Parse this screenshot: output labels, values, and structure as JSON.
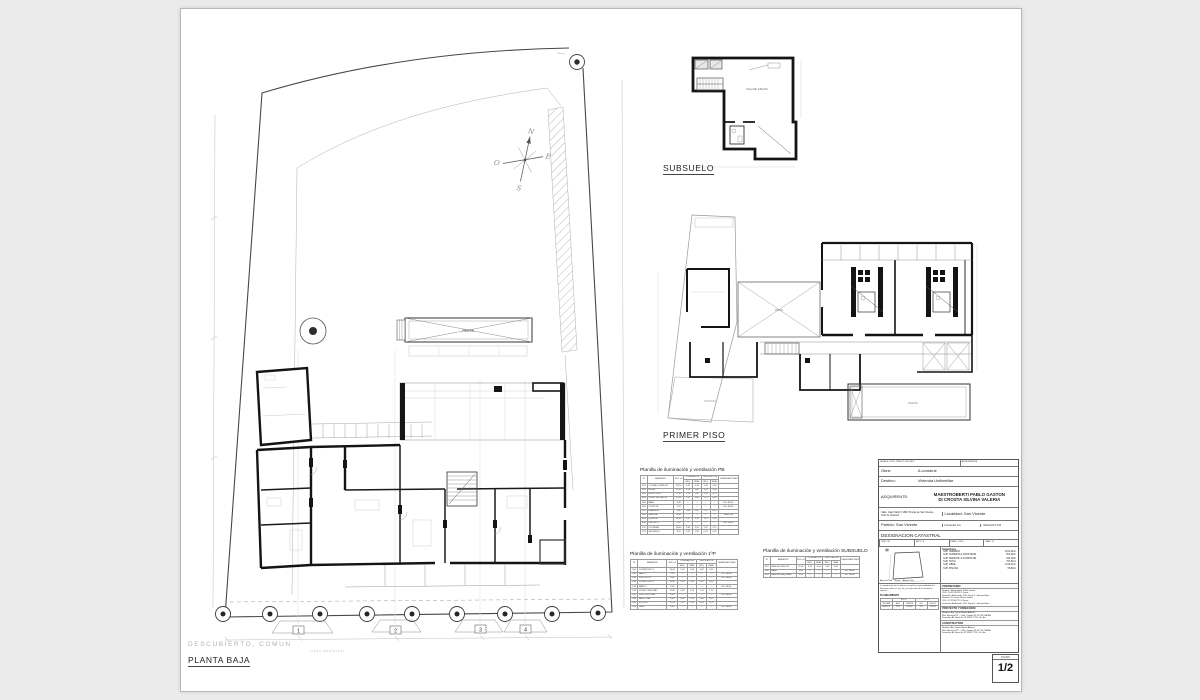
{
  "page": {
    "plano_label": "PLANO",
    "plano_value": "1/2"
  },
  "labels": {
    "planta_baja": "PLANTA BAJA",
    "subsuelo": "SUBSUELO",
    "primer_piso": "PRIMER PISO",
    "descubierto": "DESCUBIERTO, COMUN"
  },
  "compass": {
    "n": "N",
    "s": "S",
    "e": "E",
    "o": "O"
  },
  "site": {
    "pool_label": "PILETA",
    "grid_labels": [
      "1",
      "2",
      "3",
      "4"
    ],
    "street_note": "LINEA MUNICIPAL"
  },
  "plans": {
    "subsuelo_room": "SALA DE JUEGOS",
    "p1_void": "VACIO",
    "p1_terrace": "TERRAZA",
    "p1_pool": "PILETA"
  },
  "tables": {
    "common": {
      "n": "Nº",
      "amb": "AMBIENTE",
      "sup": "SUP. m²",
      "ilum": "ILUMINACION",
      "vent": "VENTILACION",
      "req": "REQ.",
      "real": "REAL",
      "obs": "OBSERVACIONES"
    },
    "pb": {
      "title": "Planilla de iluminación y ventilación PB",
      "rows": [
        [
          "E01",
          "COCINA-COMEDOR",
          "48,70",
          "4,87",
          "5,10",
          "2,43",
          "2,60",
          ""
        ],
        [
          "E02",
          "ESTAR",
          "32,40",
          "3,24",
          "3,60",
          "1,62",
          "1,80",
          ""
        ],
        [
          "E03",
          "ESCRITORIO",
          "12,60",
          "1,26",
          "1,40",
          "0,63",
          "0,70",
          ""
        ],
        [
          "E04",
          "DORM. INVITADOS",
          "14,20",
          "1,42",
          "1,60",
          "0,71",
          "0,80",
          ""
        ],
        [
          "E05",
          "BAÑO",
          "4,80",
          "—",
          "—",
          "—",
          "—",
          "S.E. REGL."
        ],
        [
          "E06",
          "TOILETTE",
          "2,10",
          "—",
          "—",
          "—",
          "—",
          "S.E. REGL."
        ],
        [
          "E07",
          "LAVADERO",
          "6,40",
          "0,64",
          "0,80",
          "0,32",
          "0,40",
          ""
        ],
        [
          "E08",
          "GALERIA",
          "28,60",
          "—",
          "—",
          "—",
          "—",
          "SEMICUB."
        ],
        [
          "E09",
          "QUINCHO",
          "36,20",
          "3,62",
          "4,10",
          "1,81",
          "2,05",
          ""
        ],
        [
          "E10",
          "DEPOSITO",
          "5,20",
          "—",
          "—",
          "—",
          "—",
          "S.E. REGL."
        ],
        [
          "E11",
          "COCHERA",
          "38,40",
          "3,84",
          "4,20",
          "1,92",
          "2,10",
          ""
        ],
        [
          "E12",
          "VESTIBULO",
          "8,10",
          "0,81",
          "1,00",
          "0,41",
          "0,50",
          ""
        ]
      ]
    },
    "p1": {
      "title": "Planilla de iluminación y ventilación 1ºP",
      "rows": [
        [
          "D01",
          "DORMITORIO 1",
          "16,40",
          "1,64",
          "1,80",
          "0,82",
          "0,90",
          ""
        ],
        [
          "D02",
          "BAÑO 1",
          "5,20",
          "—",
          "—",
          "—",
          "—",
          "S.E. REGL."
        ],
        [
          "D03",
          "VESTIDOR 1",
          "4,60",
          "—",
          "—",
          "—",
          "—",
          "S.E. REGL."
        ],
        [
          "D04",
          "DORMITORIO 2",
          "16,40",
          "1,64",
          "1,80",
          "0,82",
          "0,90",
          ""
        ],
        [
          "D05",
          "BAÑO 2",
          "5,20",
          "—",
          "—",
          "—",
          "—",
          "S.E. REGL."
        ],
        [
          "D06",
          "DORM. PRINCIPAL",
          "22,80",
          "2,28",
          "2,50",
          "1,14",
          "1,25",
          ""
        ],
        [
          "D07",
          "VESTIDOR PPAL.",
          "8,40",
          "—",
          "—",
          "—",
          "—",
          "S.E. REGL."
        ],
        [
          "D08",
          "BAÑO PPAL.",
          "9,60",
          "0,96",
          "1,10",
          "0,48",
          "0,55",
          ""
        ],
        [
          "D09",
          "ESTUDIO",
          "12,20",
          "1,22",
          "1,40",
          "0,61",
          "0,70",
          ""
        ],
        [
          "D10",
          "PASO",
          "6,80",
          "—",
          "—",
          "—",
          "—",
          "S.E. REGL."
        ]
      ]
    },
    "ss": {
      "title": "Planilla de iluminación y ventilación SUBSUELO",
      "rows": [
        [
          "S01",
          "SALA DE JUEGOS",
          "52,40",
          "5,24",
          "5,60",
          "2,62",
          "2,80",
          ""
        ],
        [
          "S02",
          "BAÑO",
          "3,80",
          "—",
          "—",
          "—",
          "—",
          "S.E. REGL."
        ],
        [
          "S03",
          "SALA DE MAQUINAS",
          "9,20",
          "—",
          "—",
          "—",
          "—",
          "S.E. REGL."
        ]
      ]
    }
  },
  "title_block": {
    "header_left": "GUIA DE CONT. TRIB. Nº 3-81 59F.3",
    "header_right": "ANTECEDENTE",
    "obra_label": "Obra:",
    "obra_value": "A construir",
    "destino_label": "Destino:",
    "destino_value": "Vivienda Unifamiliar",
    "adquirente_label": "ADQUIRENTE:",
    "adquirente_line1": "MAESTROBERTI PABLO GASTON",
    "adquirente_line2": "DI CROSTA SILVINA VALERIA",
    "calle": "Calle: Juan Pablo II 1660 \"Fincas de San Vicente - Club de Chacras\"",
    "localidad": "Localidad: San Vicente",
    "partido": "Partido: San Vicente",
    "fna": "Fna de Ets. No.",
    "escala": "ESCALAS 1:100",
    "catastral_title": "DESIGNACION CATASTRAL",
    "catastral_cells": [
      "CIRC: VII",
      "SECC: S",
      "FRACC: 2223",
      "PARC: 11"
    ],
    "superficies_title": "Superficies",
    "superficies": [
      [
        "SUP. TERRENO",
        "2014,22m²"
      ],
      [
        "SUP. CUBIERTA A CONSTRUIR",
        "551,62m²"
      ],
      [
        "SUP. SEMICUB. A CONSTRUIR",
        "246,19m²"
      ],
      [
        "SUP. TOTAL",
        "797,81m²"
      ],
      [
        "SUP. LIBRE",
        "1216,41m²"
      ],
      [
        "SUP. PISCINA",
        "55,80m²"
      ]
    ],
    "services": [
      "Agua de Red",
      "Cloaca",
      "Alumb. Púb."
    ],
    "note": "La aprobación de los planos no implica responsabilidad del Municipio sobre el uso, fin y la aplicación de la normativa vigente.",
    "planeamiento_title": "PLANEAMIENTO",
    "planeamiento_headers": [
      "",
      "F.O.S.",
      "F.O.T."
    ],
    "planeamiento_rows": [
      [
        "S/ZONIF.",
        "60%",
        "1208,53",
        "0,8",
        "1611,37"
      ],
      [
        "S/PROY.",
        "27%",
        "551,62",
        "0,4",
        "797,81"
      ]
    ],
    "propietario_title": "PROPIETARIO",
    "propietario_lines": [
      "Nombre: Maestroberti Pablo Gaston",
      "CUIL: 20-25235152-7    Firma:",
      "Domicilio: Avellaneda 1112, Depto 3 - Buenos Aires",
      "Nombre: Di Crosta Silvina Valeria",
      "CUIL: 27-22962777-9    Firma:",
      "Domicilio: Avellaneda 1112, Depto 3 - Buenos Aires"
    ],
    "proyecto_title": "PROYECTO Y DIRECCION",
    "proyecto_lines": [
      "Nombre: Arq. Tamer Matias Alfonso",
      "Mat. Municipal Nº —  Mat. Colegio Nº 31.223 CAPBA",
      "Domicilio: Av. Santa Fe Nº 5540, 2º B2 - Bs. As."
    ],
    "constructor_title": "CONSTRUCTOR",
    "constructor_lines": [
      "Nombre: Arq. Tamer Matias Alfonso",
      "Mat. Municipal Nº —  Mat. Colegio Nº 31.223 CAPBA",
      "Domicilio: Av. Santa Fe Nº 5540, 2º B2 - Bs. As."
    ]
  }
}
